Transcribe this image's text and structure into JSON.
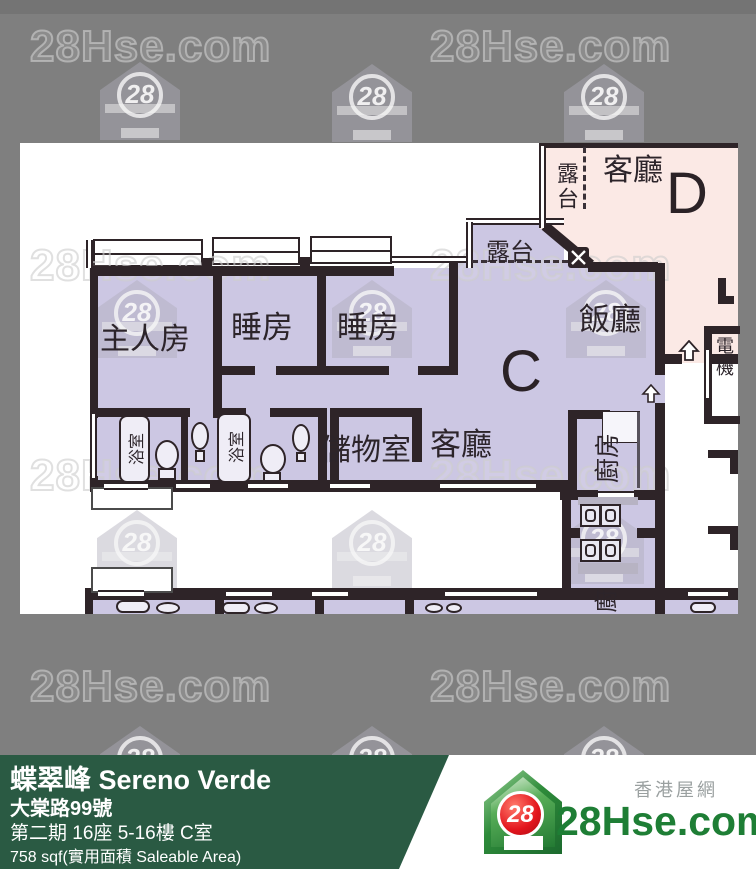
{
  "watermark": {
    "text": "28Hse.com",
    "badge": "28"
  },
  "plan": {
    "unit_c": "C",
    "unit_d": "D",
    "rooms": {
      "master_bedroom": "主人房",
      "bedroom_1": "睡房",
      "bedroom_2": "睡房",
      "dining": "飯廳",
      "living_c": "客廳",
      "living_d": "客廳",
      "storage": "儲物室",
      "kitchen": "廚房",
      "kitchen_partial": "廚",
      "bathroom_1": "浴室",
      "bathroom_2": "浴室",
      "balcony_c": "露台",
      "balcony_d": "露台",
      "electrical": "電機"
    }
  },
  "footer": {
    "title": "蝶翠峰 Sereno Verde",
    "address": "大棠路99號",
    "unit_info": "第二期 16座 5-16樓 C室",
    "area": "758 sqf(實用面積 Saleable Area)"
  },
  "logo": {
    "badge": "28",
    "brand": "28Hse.com",
    "tagline": "香港屋網"
  },
  "colors": {
    "unit_c_fill": "#ccc7e3",
    "unit_d_fill": "#fbe9e5",
    "wall": "#2e2428",
    "footer_green": "#2a5a43",
    "background": "#7f7f7f"
  }
}
